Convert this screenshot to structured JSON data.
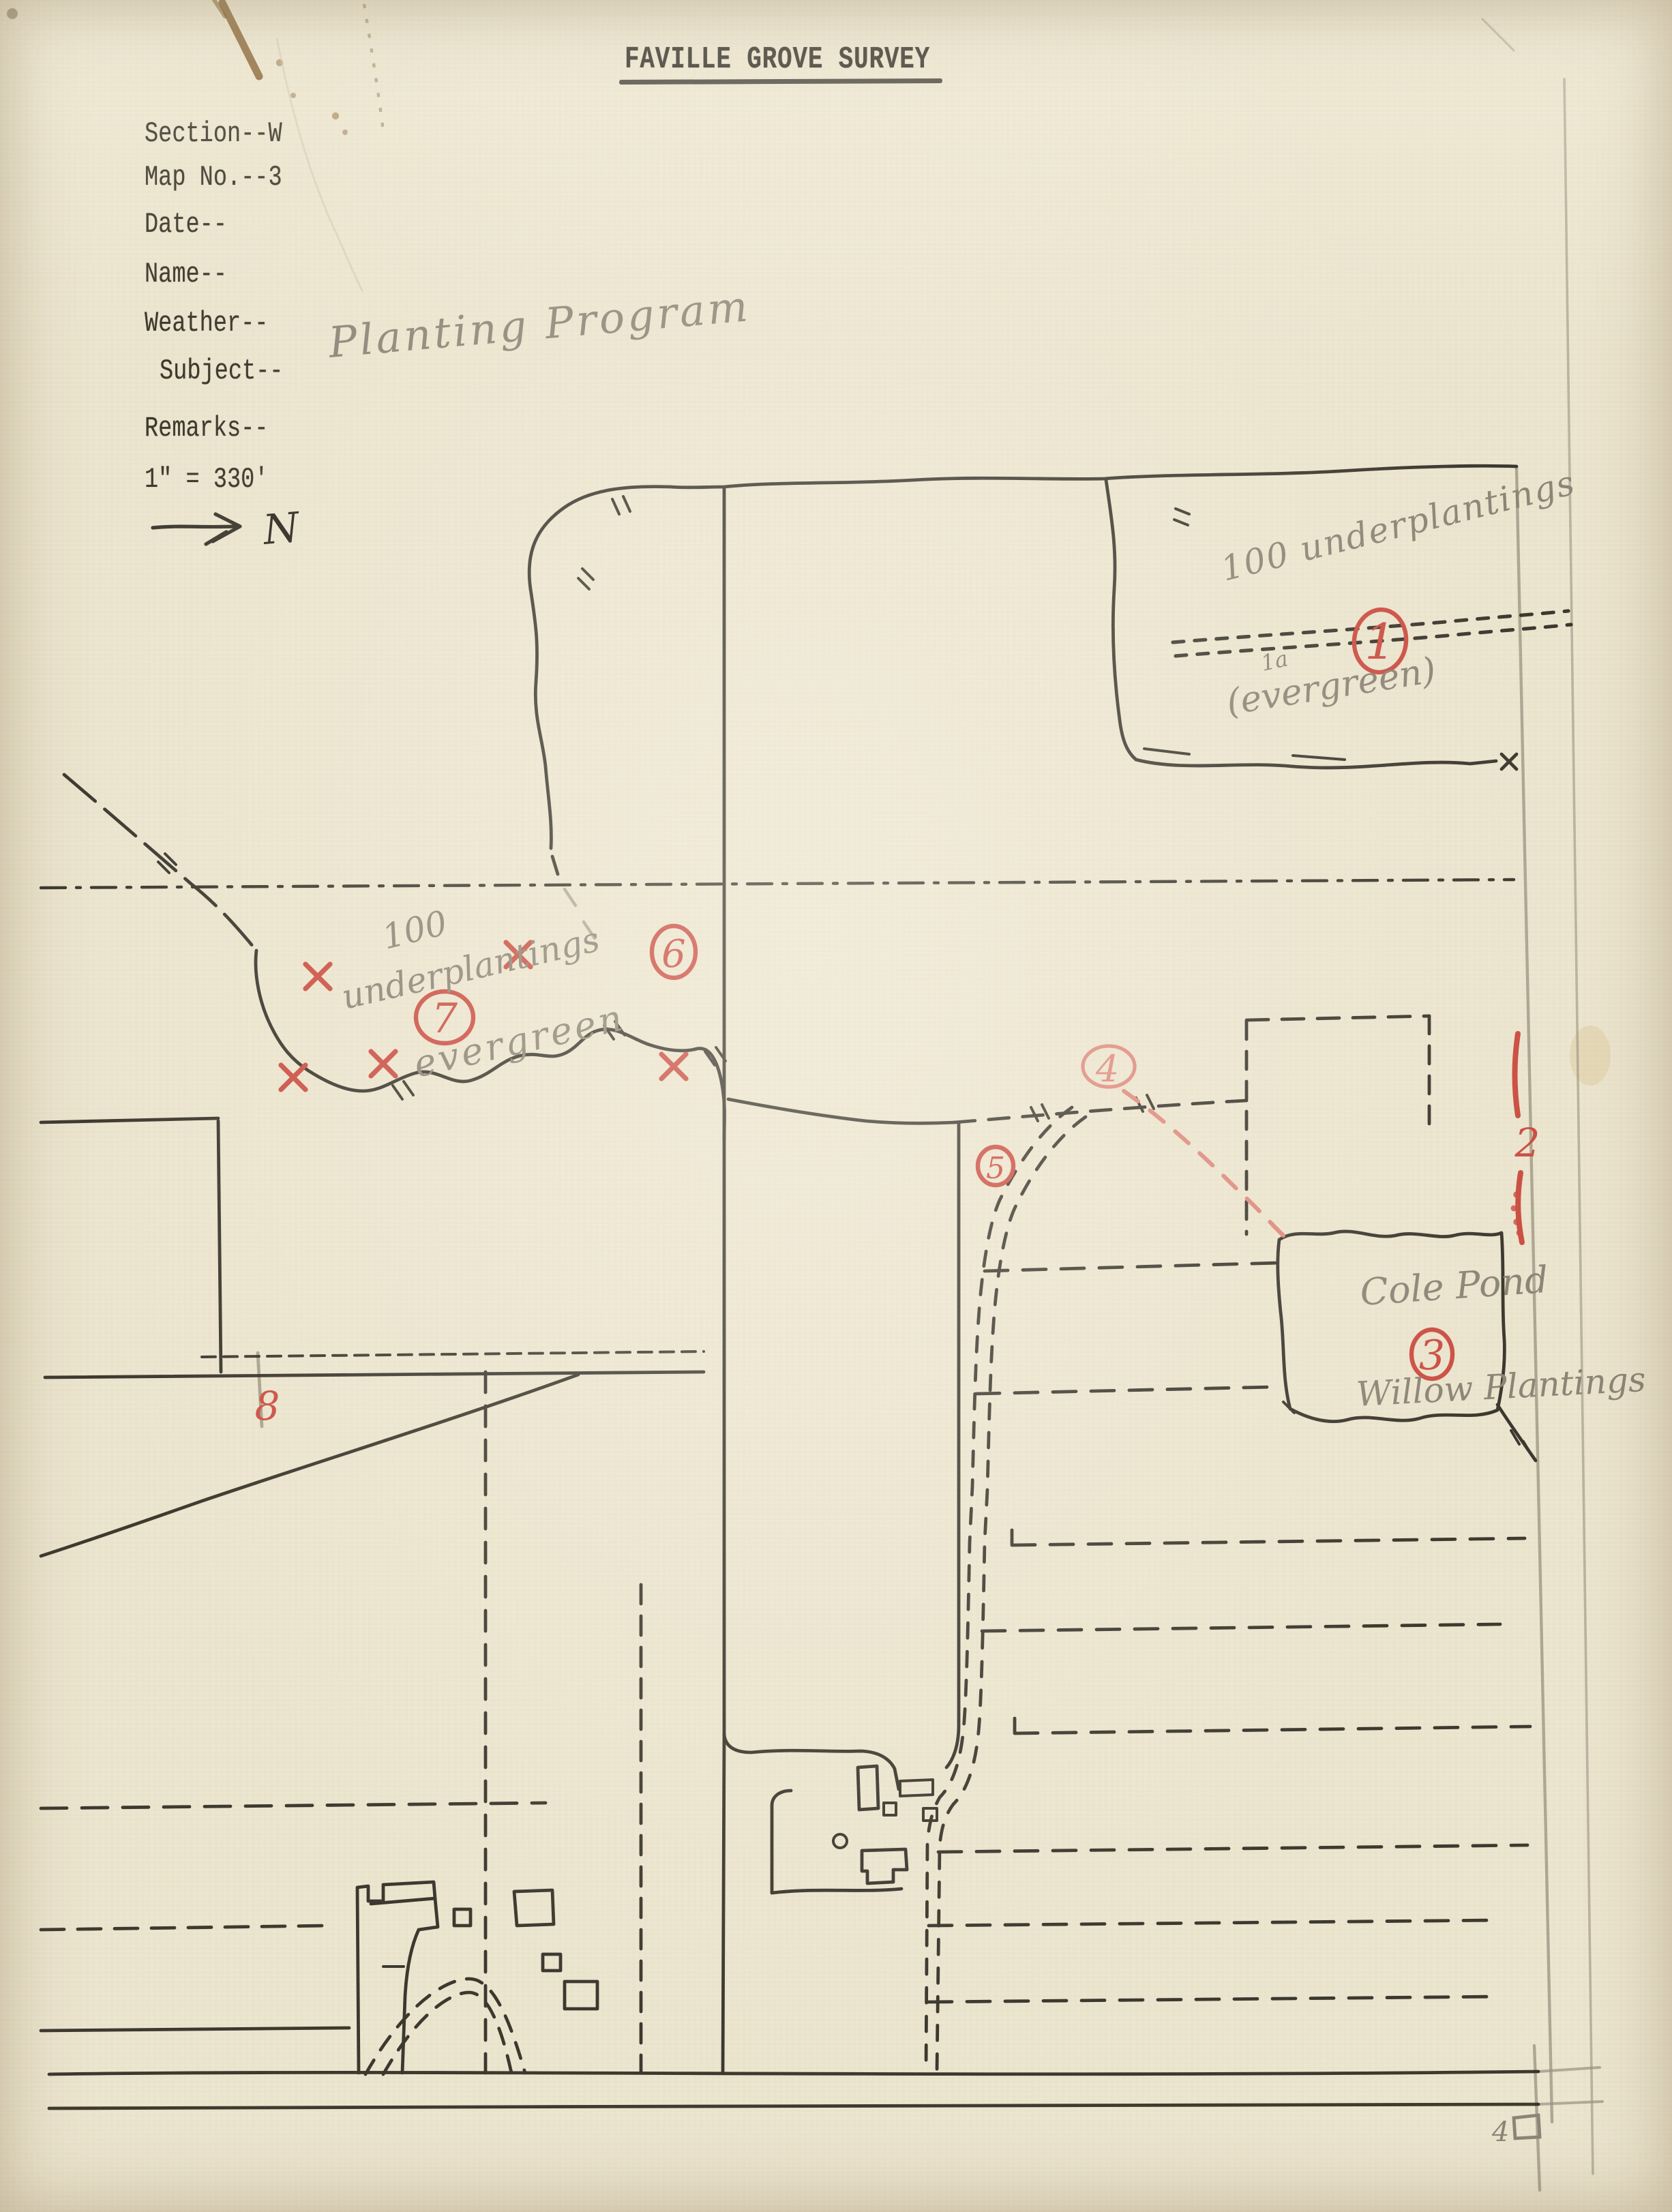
{
  "document": {
    "title": "FAVILLE GROVE SURVEY",
    "fields": [
      {
        "label": "Section--W"
      },
      {
        "label": "Map No.--3"
      },
      {
        "label": "Date--"
      },
      {
        "label": "Name--"
      },
      {
        "label": "Weather--"
      },
      {
        "label": "Subject--"
      },
      {
        "label": "Remarks--"
      },
      {
        "label": "1\" = 330'"
      }
    ],
    "subject_value": "Planting Program",
    "north_label": "N"
  },
  "map": {
    "annotations": {
      "ne_count": "100 underplantings",
      "ne_sub": "1a",
      "ne_species": "(evergreen)",
      "w_count": "100",
      "w_type": "underplantings",
      "w_species": "evergreen",
      "pond_name": "Cole Pond",
      "pond_planting": "Willow Plantings"
    },
    "markers": {
      "area1": "1",
      "area2": "2",
      "area3": "3",
      "area4": "4",
      "area5": "5",
      "area6": "6",
      "area7": "7",
      "area8": "8"
    },
    "corner_mark": "4"
  },
  "colors": {
    "paper": "#ece5cf",
    "ink": "#2e2a22",
    "pencil": "#8d8577",
    "red": "#cc4f43",
    "red_light": "#df8a7d"
  }
}
